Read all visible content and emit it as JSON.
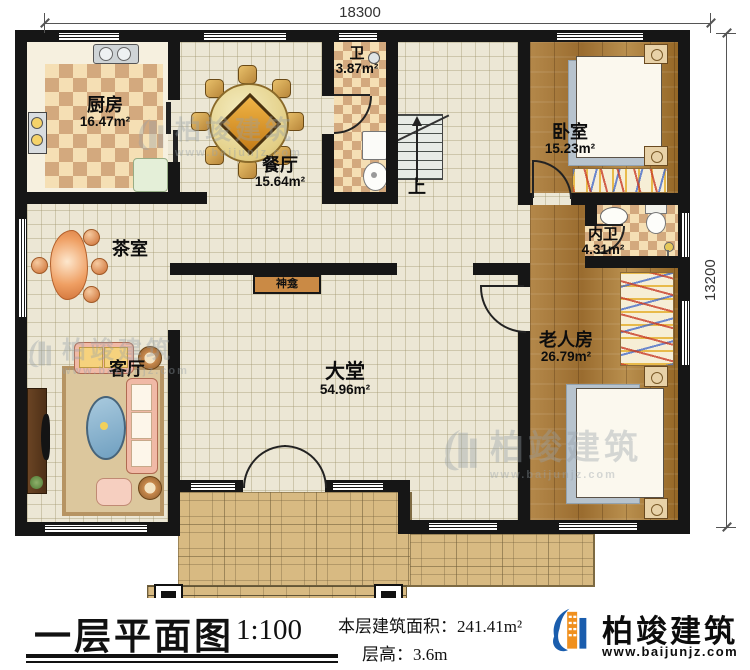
{
  "dimensions": {
    "width_mm": "18300",
    "height_mm": "13200"
  },
  "rooms": {
    "kitchen": {
      "name": "厨房",
      "area": "16.47m²"
    },
    "dining": {
      "name": "餐厅",
      "area": "15.64m²"
    },
    "bath": {
      "name": "卫",
      "area": "3.87m²"
    },
    "bedroom": {
      "name": "卧室",
      "area": "15.23m²"
    },
    "ensuite": {
      "name": "内卫",
      "area": "4.31m²"
    },
    "tea_room": {
      "name": "茶室"
    },
    "living": {
      "name": "客厅"
    },
    "hall": {
      "name": "大堂",
      "area": "54.96m²"
    },
    "elder_room": {
      "name": "老人房",
      "area": "26.79m²"
    }
  },
  "plan_labels": {
    "shrine": "神龛",
    "stairs_up": "上"
  },
  "footer": {
    "title": "一层平面图",
    "scale": "1:100",
    "area_label": "本层建筑面积：",
    "area_value": "241.41m²",
    "height_label": "层高：",
    "height_value": "3.6m"
  },
  "brand": {
    "name": "柏竣建筑",
    "website": "www.baijunjz.com"
  },
  "colors": {
    "wall": "#161616",
    "tile_floor": "#ece7d5",
    "checker_dark": "#d3a97e",
    "wood_floor": "#a87a3c",
    "porch": "#d8ba82",
    "logo_blue": "#1a5dad",
    "logo_orange": "#f0901e",
    "shrine": "#ca8a45"
  }
}
